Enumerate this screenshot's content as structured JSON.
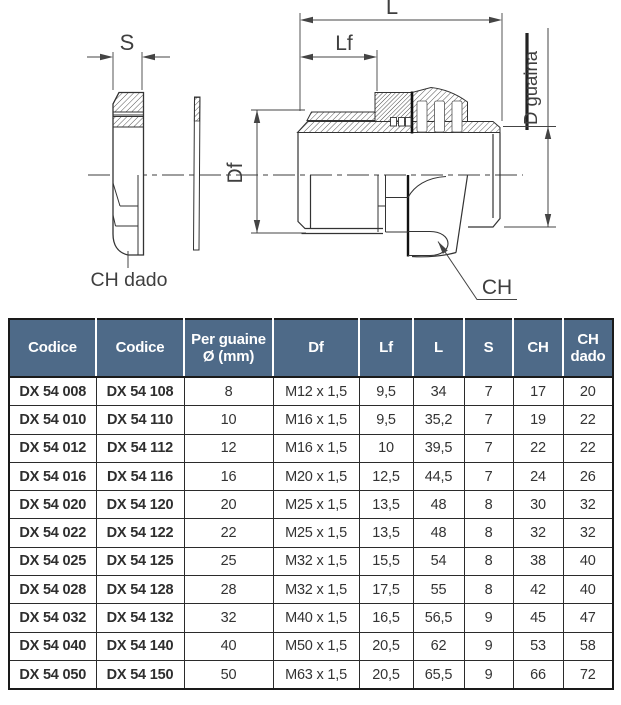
{
  "diagram": {
    "s": "S",
    "l": "L",
    "lf": "Lf",
    "df": "Df",
    "d_guaina": "D guaina",
    "ch": "CH",
    "ch_dado": "CH dado"
  },
  "table": {
    "columns": [
      "Codice",
      "Codice",
      "Per guaine\nØ (mm)",
      "Df",
      "Lf",
      "L",
      "S",
      "CH",
      "CH\ndado"
    ],
    "rows": [
      [
        "DX 54 008",
        "DX 54 108",
        "8",
        "M12 x 1,5",
        "9,5",
        "34",
        "7",
        "17",
        "20"
      ],
      [
        "DX 54 010",
        "DX 54 110",
        "10",
        "M16 x 1,5",
        "9,5",
        "35,2",
        "7",
        "19",
        "22"
      ],
      [
        "DX 54 012",
        "DX 54 112",
        "12",
        "M16 x 1,5",
        "10",
        "39,5",
        "7",
        "22",
        "22"
      ],
      [
        "DX 54 016",
        "DX 54 116",
        "16",
        "M20 x 1,5",
        "12,5",
        "44,5",
        "7",
        "24",
        "26"
      ],
      [
        "DX 54 020",
        "DX 54 120",
        "20",
        "M25 x 1,5",
        "13,5",
        "48",
        "8",
        "30",
        "32"
      ],
      [
        "DX 54 022",
        "DX 54 122",
        "22",
        "M25 x 1,5",
        "13,5",
        "48",
        "8",
        "32",
        "32"
      ],
      [
        "DX 54 025",
        "DX 54 125",
        "25",
        "M32 x 1,5",
        "15,5",
        "54",
        "8",
        "38",
        "40"
      ],
      [
        "DX 54 028",
        "DX 54 128",
        "28",
        "M32 x 1,5",
        "17,5",
        "55",
        "8",
        "42",
        "40"
      ],
      [
        "DX 54 032",
        "DX 54 132",
        "32",
        "M40 x 1,5",
        "16,5",
        "56,5",
        "9",
        "45",
        "47"
      ],
      [
        "DX 54 040",
        "DX 54 140",
        "40",
        "M50 x 1,5",
        "20,5",
        "62",
        "9",
        "53",
        "58"
      ],
      [
        "DX 54 050",
        "DX 54 150",
        "50",
        "M63 x 1,5",
        "20,5",
        "65,5",
        "9",
        "66",
        "72"
      ]
    ]
  },
  "colors": {
    "header_bg": "#4e6a88",
    "header_text": "#ffffff",
    "border": "#1a1a1a",
    "line": "#3c3c3c"
  }
}
